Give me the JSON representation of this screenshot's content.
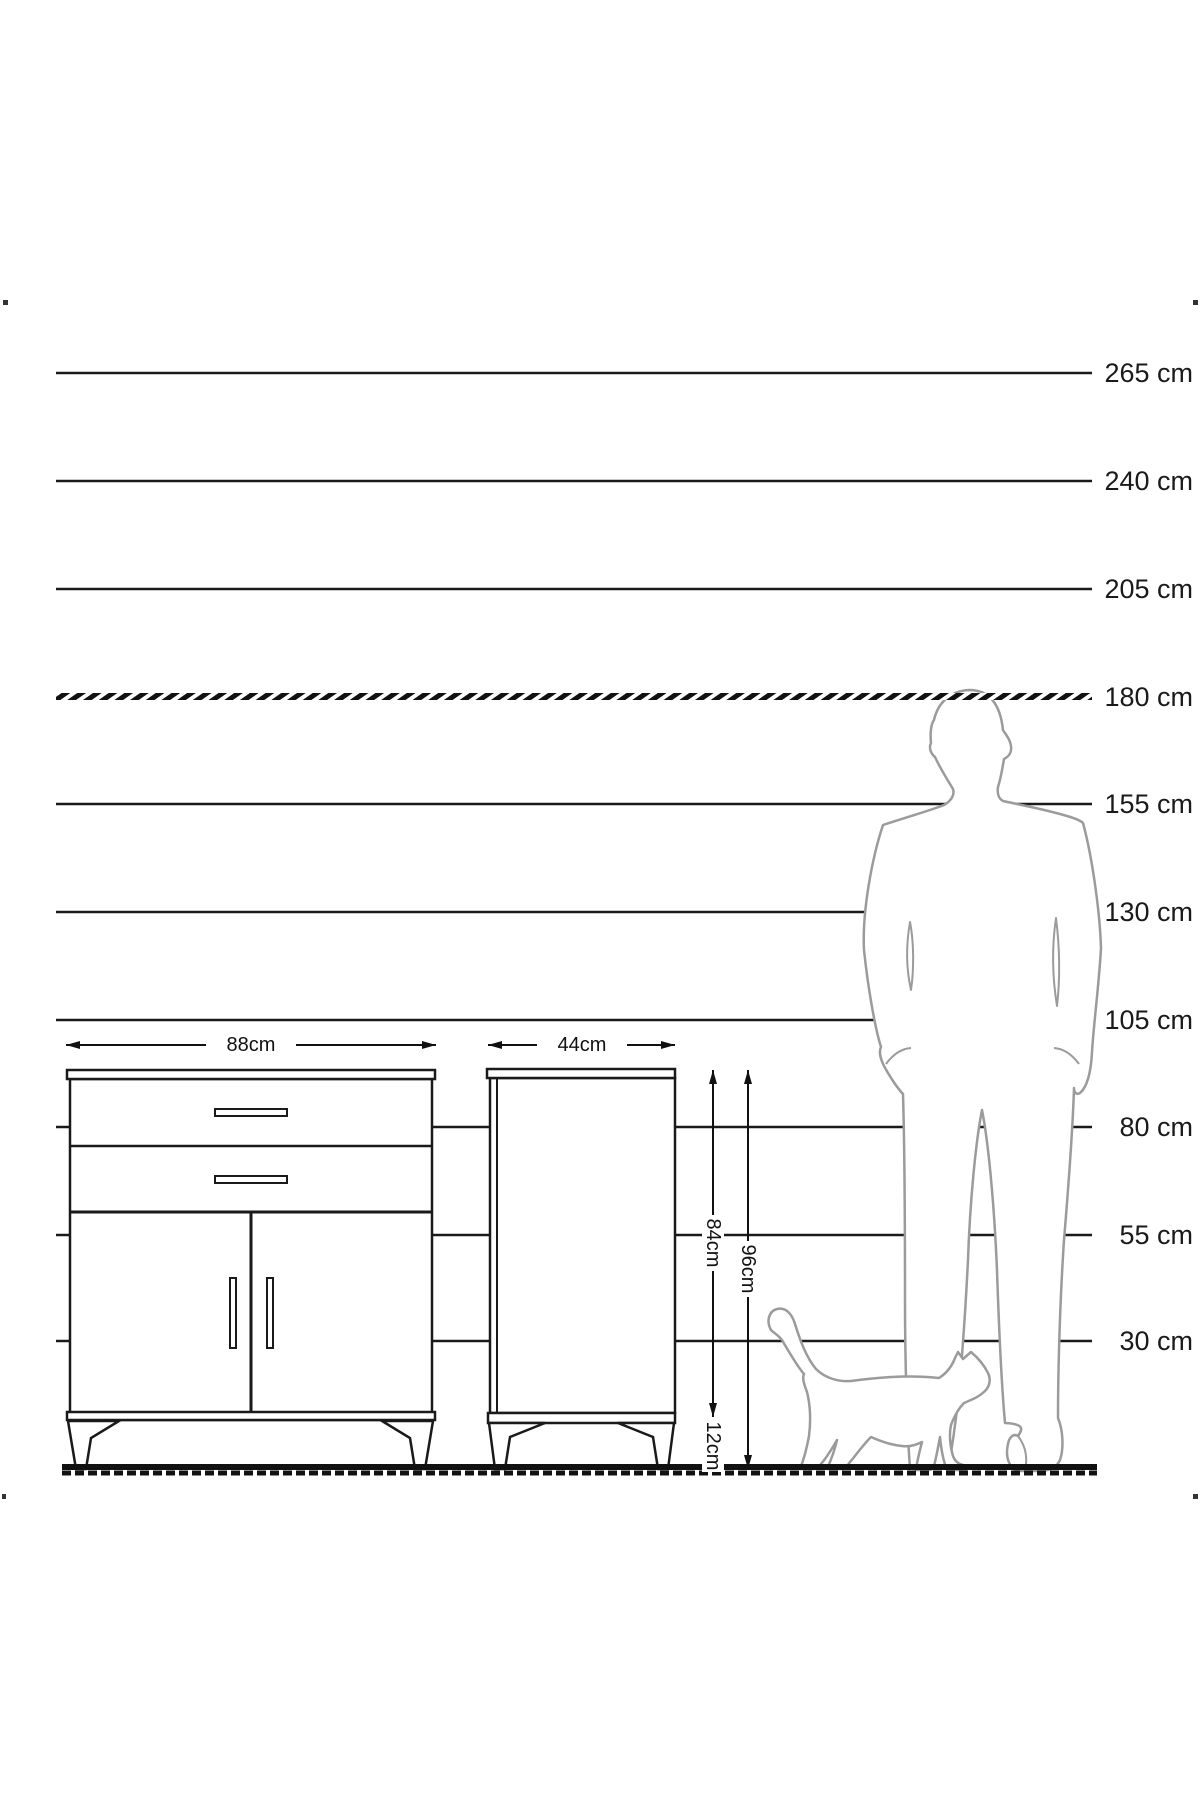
{
  "scale": {
    "unit": "cm",
    "labels": [
      "265 cm",
      "240 cm",
      "205 cm",
      "180 cm",
      "155 cm",
      "130 cm",
      "105 cm",
      "80 cm",
      "55 cm",
      "30 cm"
    ]
  },
  "dims": {
    "front_width": "88cm",
    "depth": "44cm",
    "body_height": "84cm",
    "total_height": "96cm",
    "leg_height": "12cm"
  },
  "colors": {
    "line": "#1a1a1a",
    "figure_outline": "#9b9b9b",
    "background": "#ffffff"
  }
}
